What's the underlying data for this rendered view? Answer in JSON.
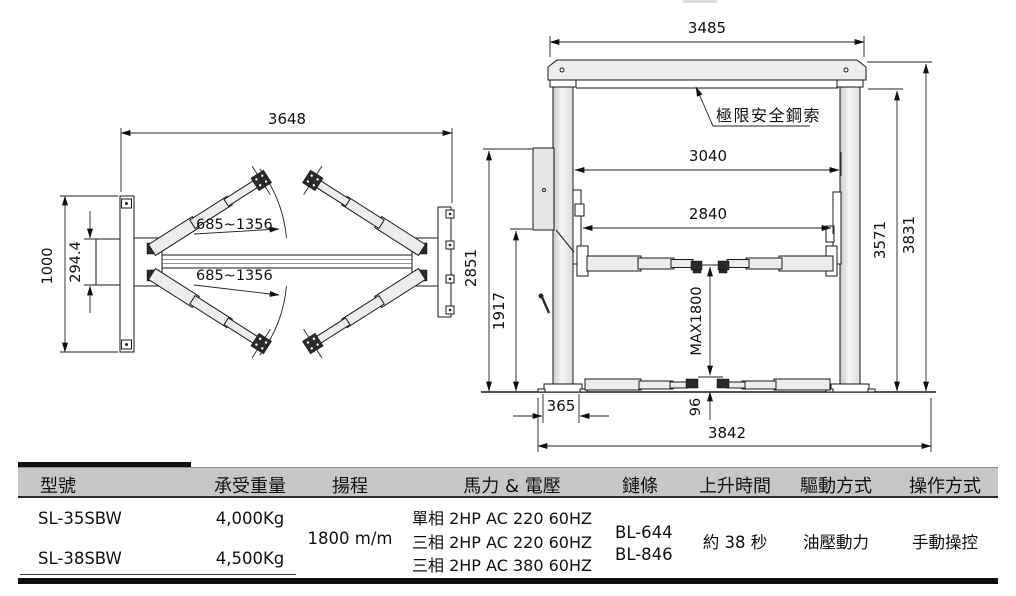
{
  "drawing": {
    "plan_view": {
      "dim_total_width": "3648",
      "dim_arm_reach_front": "685~1356",
      "dim_arm_reach_rear": "685~1356",
      "dim_base_plate_depth": "1000",
      "dim_bracket_depth": "294.4"
    },
    "front_view": {
      "label_safety_cable": "極限安全鋼索",
      "dim_beam_width": "3485",
      "dim_clear_width": "3040",
      "dim_carriage_clear_width": "2840",
      "dim_power_unit_height": "2851",
      "dim_column_lower_height": "1917",
      "dim_max_lift_height": "MAX1800",
      "dim_under_beam_height": "3571",
      "dim_overall_height": "3831",
      "dim_base_width": "365",
      "dim_min_pad_height": "96",
      "dim_overall_floor_width": "3842"
    }
  },
  "spec_table": {
    "headers": [
      "型號",
      "承受重量",
      "揚程",
      "馬力 & 電壓",
      "鏈條",
      "上升時間",
      "驅動方式",
      "操作方式"
    ],
    "models": [
      {
        "model": "SL-35SBW",
        "capacity": "4,000Kg"
      },
      {
        "model": "SL-38SBW",
        "capacity": "4,500Kg"
      }
    ],
    "lift_height": "1800 m/m",
    "power_options": [
      "單相 2HP AC 220 60HZ",
      "三相 2HP AC 220 60HZ",
      "三相 2HP AC 380 60HZ"
    ],
    "chains": [
      "BL-644",
      "BL-846"
    ],
    "rise_time": "約 38 秒",
    "drive_type": "油壓動力",
    "operation": "手動操控"
  }
}
